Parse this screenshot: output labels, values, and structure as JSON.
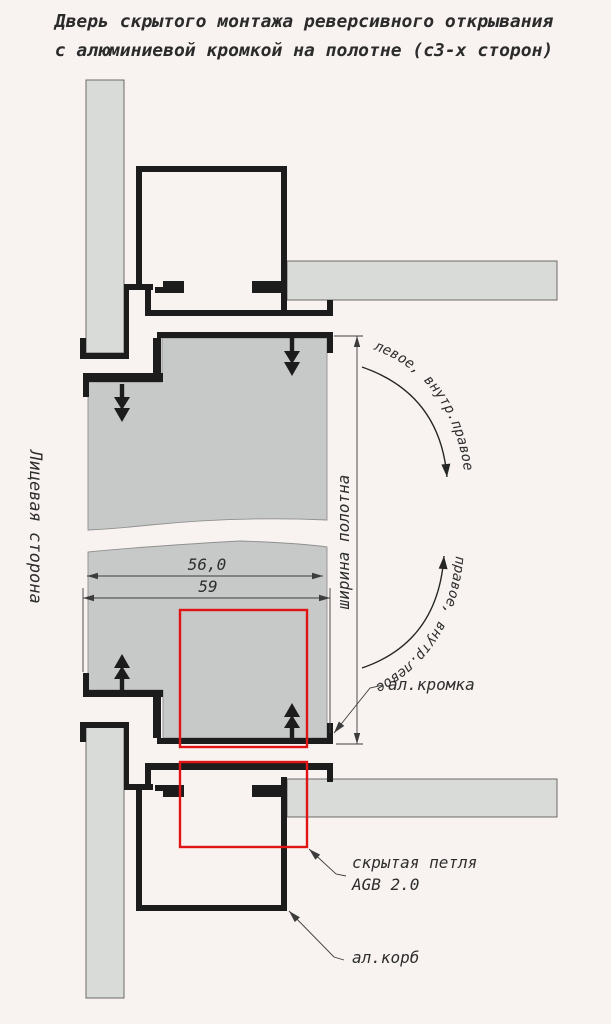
{
  "title": {
    "line1": "Дверь скрытого монтажа реверсивного открывания",
    "line2": "с алюминиевой кромкой на полотне (с3-х сторон)"
  },
  "side_label": "Лицевая сторона",
  "dimensions": {
    "panel_width_mm": "56,0",
    "frame_width_mm": "59",
    "vertical_label": "ширина полотна"
  },
  "swing_labels": {
    "upper": "левое, внутр.правое",
    "lower": "правое, внутр.левое"
  },
  "part_labels": {
    "edge": "ал.кромка",
    "hinge_line1": "скрытая петля",
    "hinge_line2": "AGB 2.0",
    "frame_box": "ал.корб"
  },
  "colors": {
    "background": "#f8f3f1",
    "panel_fill": "#c7c8c8",
    "wall_fill": "#d9dbd8",
    "ink": "#1c1c1c",
    "accent_red": "#e01414",
    "thin_line": "#3c3c3c",
    "text": "#2e2e2e"
  }
}
